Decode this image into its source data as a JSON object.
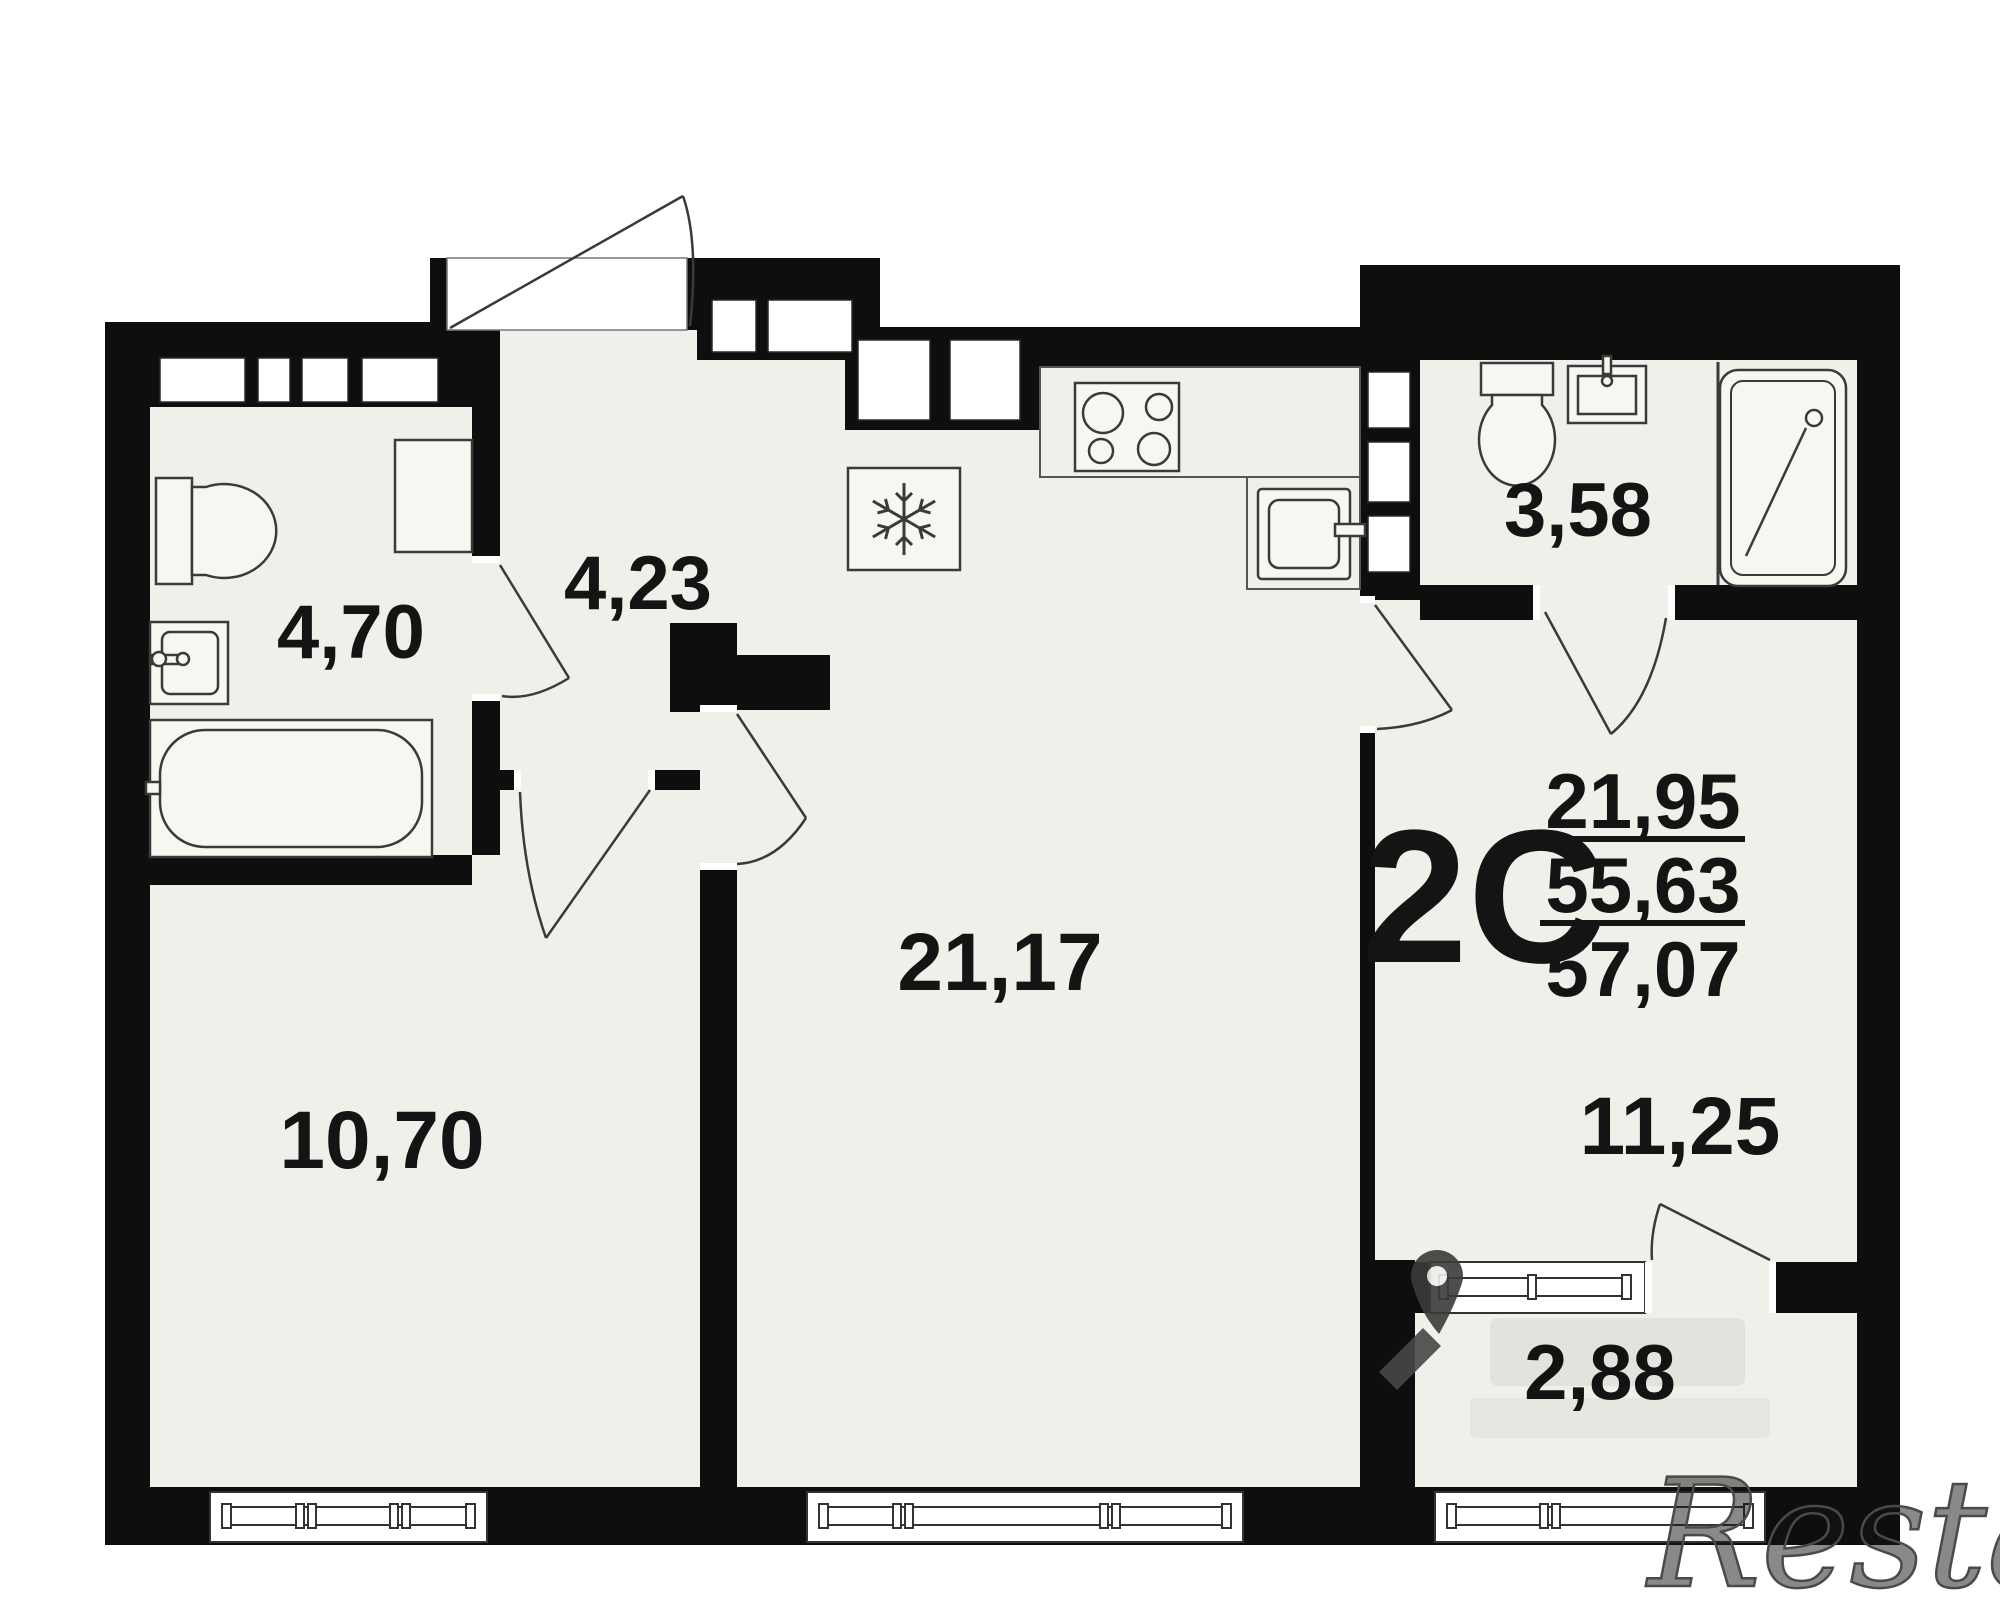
{
  "plan": {
    "apartment_code": "2С",
    "area_summary": {
      "living": "21,95",
      "apartment": "55,63",
      "total": "57,07"
    },
    "rooms": [
      {
        "name": "bathroom-left",
        "area": "4,70"
      },
      {
        "name": "entry-hall",
        "area": "4,23"
      },
      {
        "name": "bathroom-right",
        "area": "3,58"
      },
      {
        "name": "kitchen-living",
        "area": "21,17"
      },
      {
        "name": "bedroom-left",
        "area": "10,70"
      },
      {
        "name": "bedroom-right",
        "area": "11,25"
      },
      {
        "name": "balcony",
        "area": "2,88"
      }
    ],
    "colors": {
      "wall": "#0e0e0e",
      "floor": "#f1efe9",
      "line": "#3a3a3a"
    }
  },
  "watermark": {
    "brand": "Restate"
  }
}
